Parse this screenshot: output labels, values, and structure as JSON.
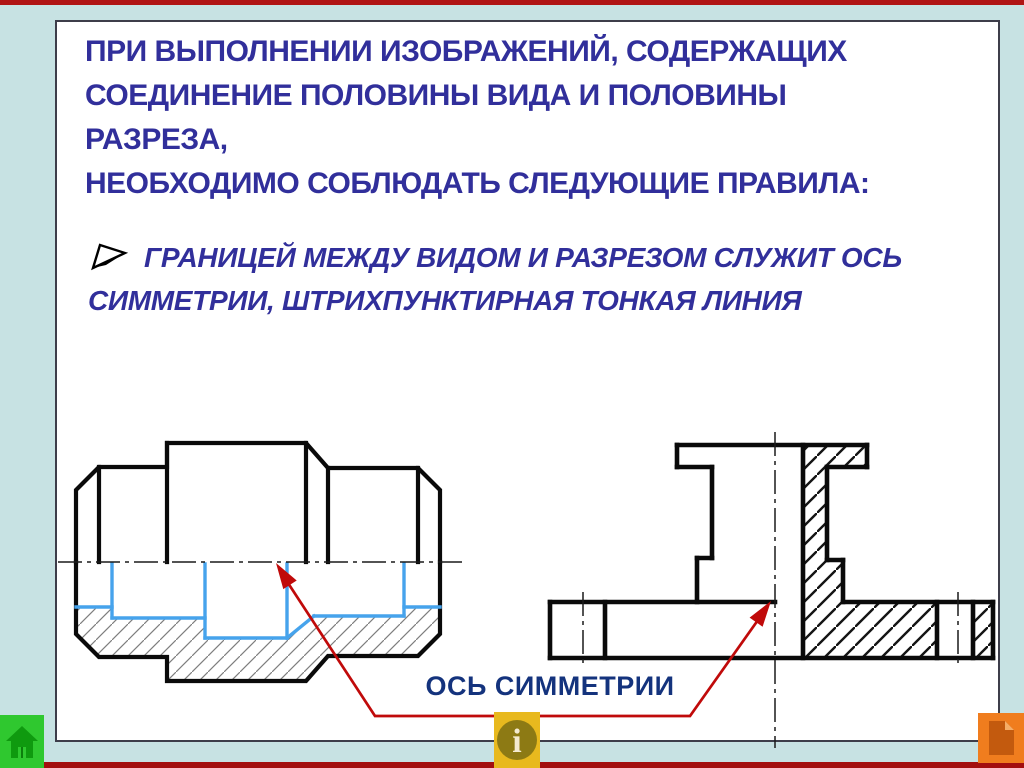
{
  "slide": {
    "title_lines": [
      "ПРИ ВЫПОЛНЕНИИ ИЗОБРАЖЕНИЙ, СОДЕРЖАЩИХ",
      "СОЕДИНЕНИЕ ПОЛОВИНЫ ВИДА И ПОЛОВИНЫ РАЗРЕЗА,",
      "НЕОБХОДИМО СОБЛЮДАТЬ СЛЕДУЮЩИЕ ПРАВИЛА:"
    ],
    "bullet": {
      "marker_icon": "arrow-bullet-icon",
      "lines": [
        "ГРАНИЦЕЙ МЕЖДУ ВИДОМ И РАЗРЕЗОМ СЛУЖИТ ОСЬ",
        "СИММЕТРИИ, ШТРИХПУНКТИРНАЯ ТОНКАЯ ЛИНИЯ"
      ]
    },
    "callout_label": "ОСЬ СИММЕТРИИ",
    "figures": {
      "left": "half-view / half-section of pipe union, bore edges highlighted blue, lower half hatched",
      "right": "half-view / half-section of flanged hub, right half hatched, axis of symmetry dash-dot line"
    }
  },
  "nav": {
    "home": {
      "icon": "home-icon"
    },
    "info": {
      "icon": "info-icon"
    },
    "next": {
      "icon": "document-page-icon"
    }
  },
  "colors": {
    "background": "#c7e2e3",
    "accent_red_strip": "#b01414",
    "title_text": "#312f9b",
    "callout_text": "#14337d",
    "callout_line_red": "#c00a0a",
    "bore_highlight_blue": "#46a3ec",
    "drawing_black": "#0a0a0a",
    "home_green": "#2fc82f",
    "info_yellow": "#e8b91e",
    "next_orange": "#f07d1e"
  }
}
